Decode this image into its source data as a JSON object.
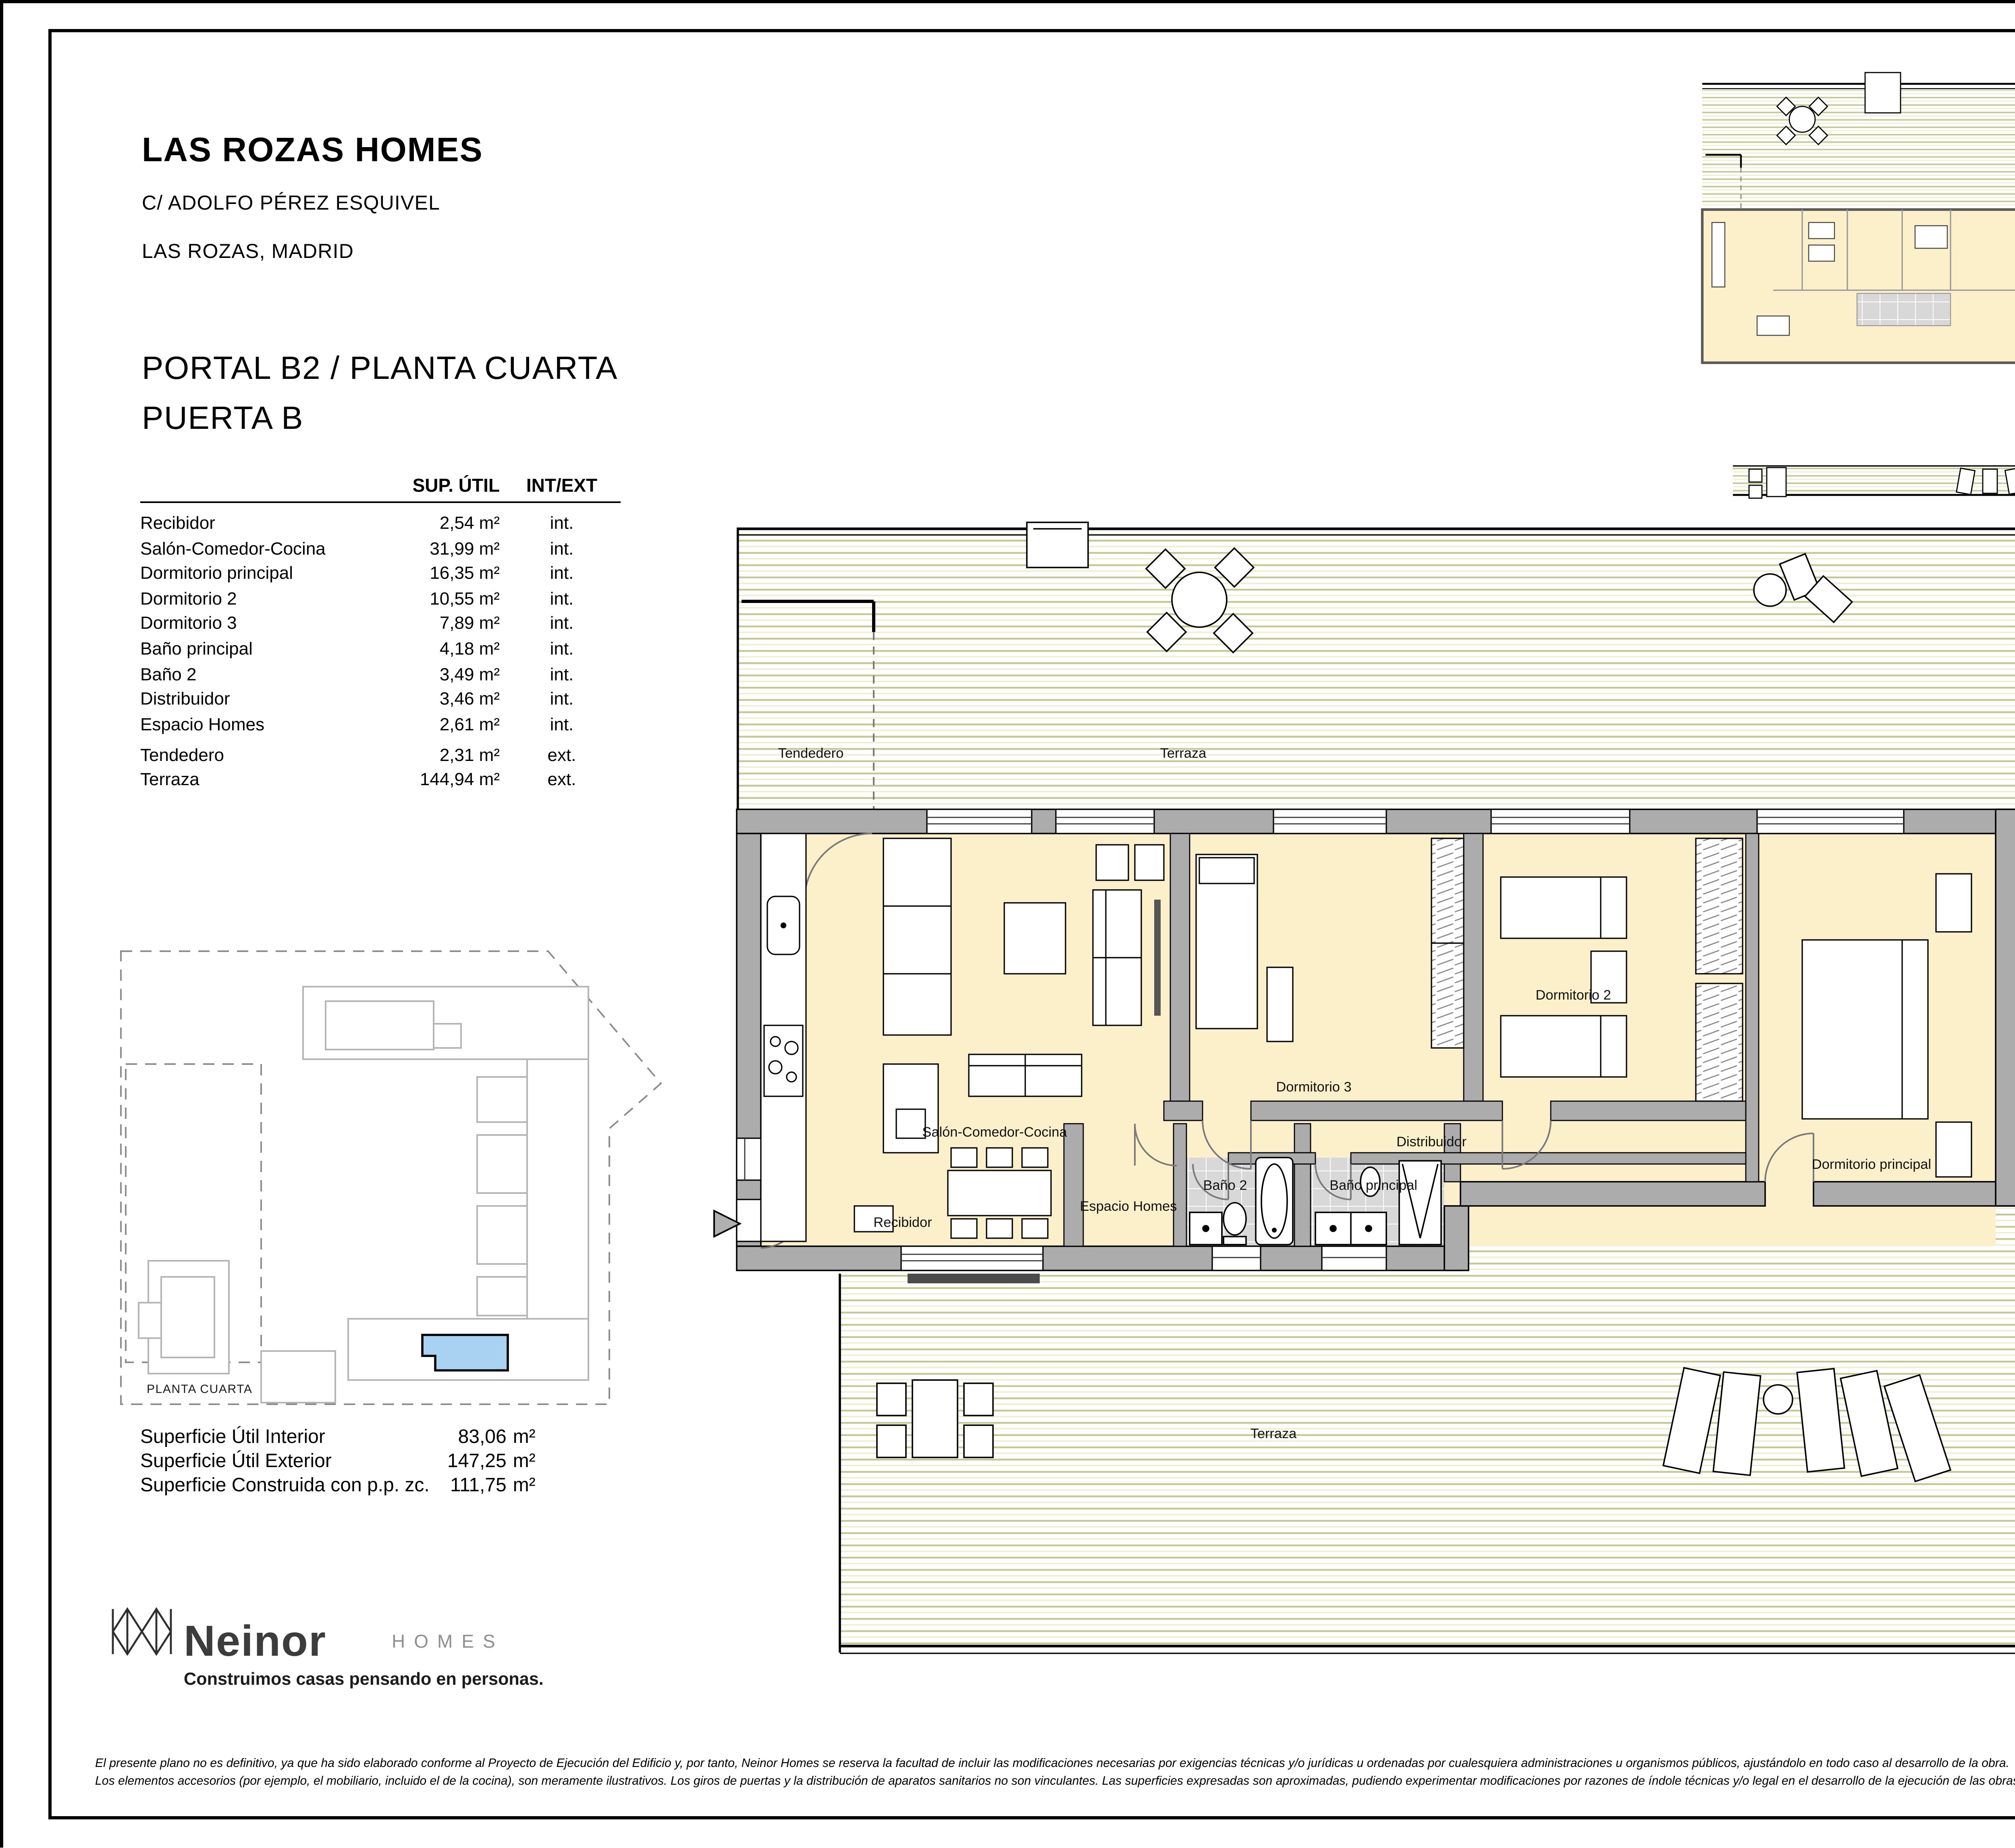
{
  "header": {
    "project": "LAS ROZAS HOMES",
    "address": "C/ ADOLFO PÉREZ ESQUIVEL",
    "city": "LAS ROZAS, MADRID",
    "unit_line1": "PORTAL B2 / PLANTA CUARTA",
    "unit_line2": "PUERTA B"
  },
  "areas_table": {
    "col_area": "SUP. ÚTIL",
    "col_type": "INT/EXT",
    "rows": [
      {
        "name": "Recibidor",
        "area": "2,54 m²",
        "type": "int."
      },
      {
        "name": "Salón-Comedor-Cocina",
        "area": "31,99 m²",
        "type": "int."
      },
      {
        "name": "Dormitorio principal",
        "area": "16,35 m²",
        "type": "int."
      },
      {
        "name": "Dormitorio 2",
        "area": "10,55 m²",
        "type": "int."
      },
      {
        "name": "Dormitorio 3",
        "area": "7,89 m²",
        "type": "int."
      },
      {
        "name": "Baño principal",
        "area": "4,18 m²",
        "type": "int."
      },
      {
        "name": "Baño 2",
        "area": "3,49 m²",
        "type": "int."
      },
      {
        "name": "Distribuidor",
        "area": "3,46 m²",
        "type": "int."
      },
      {
        "name": "Espacio Homes",
        "area": "2,61 m²",
        "type": "int."
      },
      {
        "name": "Tendedero",
        "area": "2,31 m²",
        "type": "ext."
      },
      {
        "name": "Terraza",
        "area": "144,94 m²",
        "type": "ext."
      }
    ]
  },
  "summary": {
    "rows": [
      {
        "label": "Superficie Útil Interior",
        "value": "83,06",
        "unit": "m²"
      },
      {
        "label": "Superficie Útil Exterior",
        "value": "147,25",
        "unit": "m²"
      },
      {
        "label": "Superficie Construida con p.p. zc.",
        "value": "111,75",
        "unit": "m²"
      }
    ]
  },
  "key_plan": {
    "floor_label": "PLANTA CUARTA",
    "highlight_color": "#A9D2F2"
  },
  "plan_labels": {
    "tendedero": "Tendedero",
    "terraza_top": "Terraza",
    "salon": "Salón-Comedor-Cocina",
    "recibidor": "Recibidor",
    "dorm3": "Dormitorio 3",
    "dorm2": "Dormitorio 2",
    "dorm_ppal": "Dormitorio principal",
    "distribuidor": "Distribuidor",
    "espacio": "Espacio Homes",
    "bano2": "Baño 2",
    "bano_ppal": "Baño principal",
    "terraza_bottom": "Terraza"
  },
  "logo": {
    "brand": "Neinor",
    "sub": "HOMES",
    "tagline": "Construimos casas pensando en personas."
  },
  "footer": {
    "version": "V.02 - DICIEMBRE 2024",
    "scale_label": "ESCALA GRÁFICA",
    "scale_ticks": [
      "0",
      "1",
      "2",
      "3"
    ],
    "disclaimer_line1": "El presente plano no es definitivo, ya que ha sido elaborado conforme al Proyecto de Ejecución del Edificio y, por tanto, Neinor Homes se reserva la facultad de incluir las modificaciones necesarias por exigencias técnicas y/o jurídicas u ordenadas por cualesquiera administraciones u organismos públicos, ajustándolo en todo caso al desarrollo de la obra.",
    "disclaimer_line2": "Los elementos accesorios (por ejemplo, el mobiliario, incluido el de la cocina), son meramente ilustrativos. Los giros de puertas y la distribución de aparatos sanitarios no son vinculantes. Las superficies expresadas son aproximadas, pudiendo experimentar modificaciones por razones de índole técnicas y/o legal en el desarrollo de la ejecución de las obras"
  },
  "colors": {
    "floor": "#FBF0CA",
    "wall": "#ACACAC",
    "deck_line": "#C3C88F",
    "tile": "#D8D8D8",
    "highlight": "#A9D2F2"
  }
}
